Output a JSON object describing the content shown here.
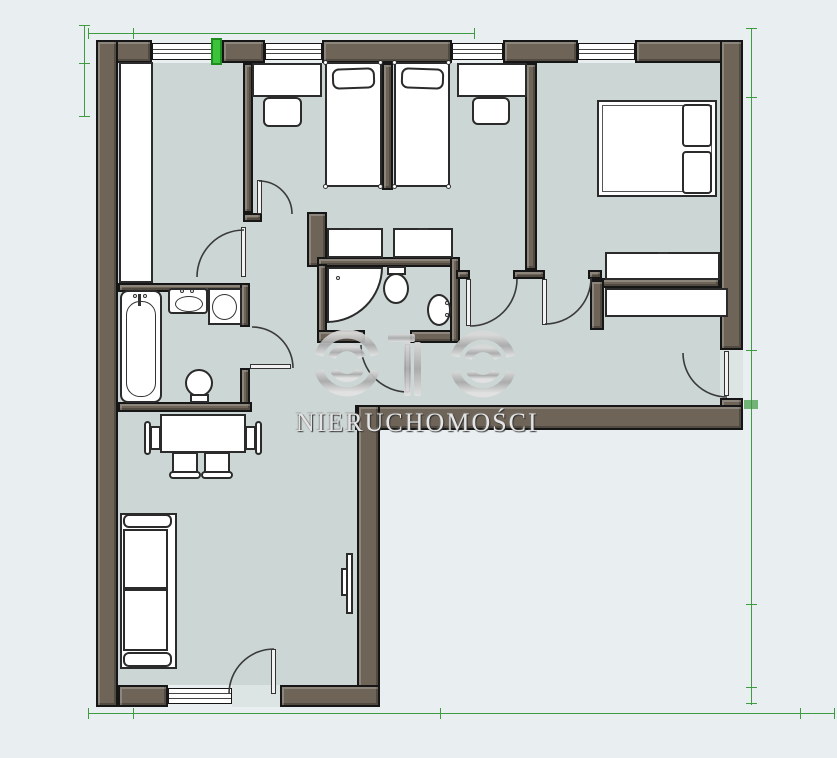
{
  "watermark": {
    "logo_text": "OTO",
    "subtitle": "NIERUCHOMOŚCI"
  },
  "colors": {
    "wall": "#6e6458",
    "line": "#161616",
    "floor": "#ccd6d4",
    "outside": "#e9eef1",
    "furn": "#ffffff",
    "furn-line": "#2b2b2b",
    "door-arc": "#3a3a3a",
    "green-accent": "#3bc43b",
    "green-accent-dark": "#1f8c1f",
    "green-dim": "#3f9b41",
    "silver": "#bdbdbd",
    "wm-text": "#e4e4e4"
  },
  "floorplan": {
    "shape": "L-shaped apartment plan, walls dark taupe with black outlines, pale blue-grey floors",
    "highlight": "small bright green segment in the top exterior wall left of first bedroom window",
    "rooms": [
      {
        "id": "room-top-left",
        "furniture": [
          "built-in-unit"
        ],
        "windows": 1,
        "doors": 1
      },
      {
        "id": "bedroom-small-1",
        "furniture": [
          "single-bed",
          "pillow",
          "desk",
          "chair",
          "wardrobe"
        ],
        "windows": 1,
        "doors": 1
      },
      {
        "id": "bedroom-small-2",
        "furniture": [
          "single-bed",
          "pillow",
          "desk",
          "chair",
          "wardrobe"
        ],
        "windows": 1,
        "doors": 1
      },
      {
        "id": "master-bedroom",
        "furniture": [
          "double-bed",
          "two-pillows",
          "wardrobe"
        ],
        "windows": 1,
        "doors": 1
      },
      {
        "id": "bathroom",
        "furniture": [
          "bathtub",
          "washbasin",
          "washing-machine",
          "toilet"
        ],
        "doors": 1
      },
      {
        "id": "wc",
        "furniture": [
          "corner-shower",
          "toilet",
          "small-washbasin"
        ],
        "doors": 1
      },
      {
        "id": "hallway",
        "furniture": [
          "wardrobe"
        ],
        "exterior_doors": 1
      },
      {
        "id": "living-room",
        "furniture": [
          "dining-table",
          "armchair",
          "armchair",
          "chair",
          "chair",
          "sofa",
          "tv"
        ],
        "windows": 1,
        "entrance_doors": 1
      }
    ],
    "annotations": "thin green dimension lines with tick marks along top, left, right and bottom edges"
  }
}
